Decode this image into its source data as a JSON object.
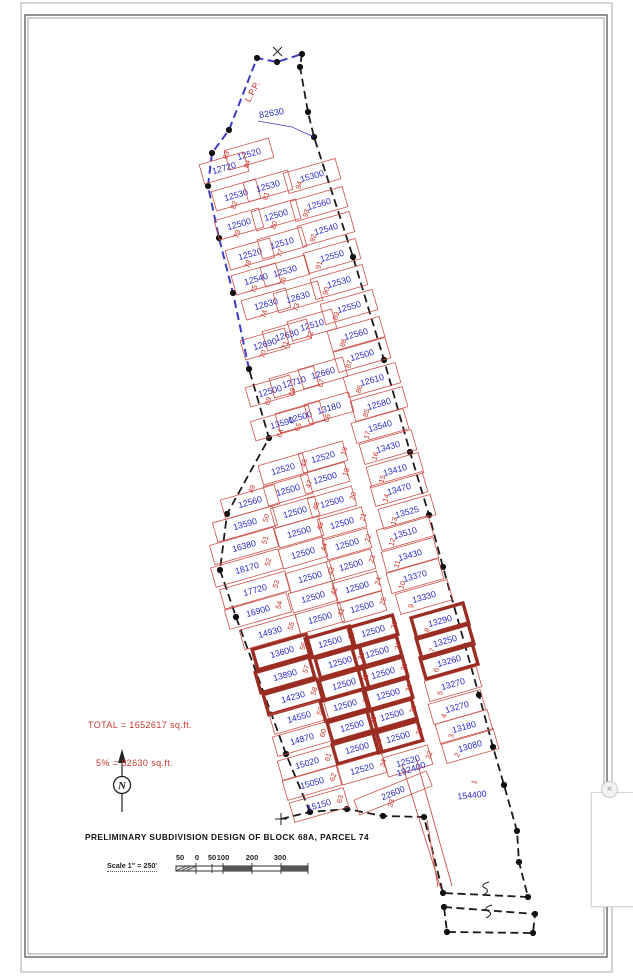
{
  "title_block": {
    "title": "PRELIMINARY SUBDIVISION DESIGN OF BLOCK 68A, PARCEL 74",
    "scale_label": "Scale 1\" = 250'",
    "scale_ticks": [
      "50",
      "0",
      "50",
      "100",
      "200",
      "300"
    ]
  },
  "summary": {
    "total_line": "TOTAL = 1652617 sq.ft.",
    "five_pct_line": "5% = 82630 sq.ft."
  },
  "north_arrow": {
    "letter": "N"
  },
  "overlay": {
    "close_glyph": "×"
  },
  "colors": {
    "lot_line_red": "#cd5149",
    "highlight_maroon": "#9c2d23",
    "area_label_blue": "#2a2ac8",
    "lot_number_red": "#c8372d",
    "boundary_black": "#1a1a1a",
    "boundary_blue": "#3c3cc4"
  },
  "map": {
    "free_labels": [
      {
        "text": "L.P.P.",
        "x": 255,
        "y": 93,
        "rot": -62,
        "color": "red"
      },
      {
        "text": "82630",
        "x": 272,
        "y": 116,
        "rot": -10,
        "color": "blue"
      },
      {
        "text": "192400",
        "x": 412,
        "y": 772,
        "rot": -18,
        "color": "blue"
      }
    ],
    "lots": {
      "columns": [
        "lot",
        "area_sqft",
        "x",
        "y",
        "number_side",
        "highlighted",
        "w",
        "h",
        "rot"
      ],
      "rows": [
        [
          "84",
          "12520",
          249,
          154,
          "b",
          false
        ],
        [
          "83",
          "12720",
          224,
          168,
          "t",
          false
        ],
        [
          "82",
          "12530",
          236,
          195,
          "b",
          false
        ],
        [
          "81",
          "12530",
          268,
          186,
          "b",
          false
        ],
        [
          "80",
          "12500",
          276,
          215,
          "b",
          false
        ],
        [
          "79",
          "12500",
          239,
          224,
          "b",
          false
        ],
        [
          "78",
          "12520",
          250,
          254,
          "b",
          false
        ],
        [
          "77",
          "12510",
          282,
          243,
          "b",
          false
        ],
        [
          "76",
          "12530",
          285,
          271,
          "b",
          false
        ],
        [
          "75",
          "12540",
          256,
          279,
          "b",
          false
        ],
        [
          "74",
          "12630",
          266,
          304,
          "b",
          false
        ],
        [
          "73",
          "12630",
          298,
          297,
          "b",
          false
        ],
        [
          "72",
          "12510",
          312,
          325,
          "b",
          false
        ],
        [
          "71",
          "12630",
          287,
          335,
          "b",
          false
        ],
        [
          "70",
          "12690",
          265,
          344,
          "b",
          false
        ],
        [
          "69",
          "12500",
          270,
          391,
          "b",
          false
        ],
        [
          "68",
          "12710",
          294,
          382,
          "b",
          false
        ],
        [
          "67",
          "12660",
          323,
          373,
          "b",
          false
        ],
        [
          "66",
          "13180",
          329,
          408,
          "b",
          false
        ],
        [
          "65",
          "12500",
          300,
          417,
          "b",
          false
        ],
        [
          "64",
          "13590",
          282,
          423,
          "b",
          false,
          60
        ],
        [
          "94",
          "15300",
          312,
          176,
          "bl",
          false,
          54,
          21
        ],
        [
          "93",
          "12560",
          319,
          204,
          "bl",
          false,
          54,
          21
        ],
        [
          "92",
          "12540",
          326,
          229,
          "bl",
          false,
          54,
          21
        ],
        [
          "91",
          "12550",
          332,
          256,
          "bl",
          false,
          54,
          21
        ],
        [
          "90",
          "12530",
          339,
          282,
          "bl",
          false,
          54,
          21
        ],
        [
          "89",
          "12550",
          349,
          307,
          "bl",
          false,
          54,
          21
        ],
        [
          "88",
          "12560",
          356,
          334,
          "bl",
          false,
          54,
          21
        ],
        [
          "87",
          "12500",
          362,
          355,
          "bl",
          false,
          54,
          21
        ],
        [
          "86",
          "12610",
          372,
          380,
          "bl",
          false,
          54,
          21
        ],
        [
          "85",
          "12580",
          379,
          404,
          "bl",
          false,
          54,
          21
        ],
        [
          "17",
          "13540",
          380,
          426,
          "bl",
          false,
          54,
          21
        ],
        [
          "16",
          "13430",
          388,
          447,
          "bl",
          false,
          54,
          21
        ],
        [
          "15",
          "13410",
          395,
          470,
          "bl",
          false,
          54,
          21
        ],
        [
          "14",
          "13470",
          399,
          489,
          "bl",
          false,
          54,
          21
        ],
        [
          "13",
          "13525",
          407,
          512,
          "bl",
          false,
          54,
          21
        ],
        [
          "12",
          "13510",
          405,
          533,
          "bl",
          false,
          54,
          21
        ],
        [
          "11",
          "13430",
          410,
          555,
          "bl",
          false,
          54,
          21
        ],
        [
          "10",
          "13370",
          415,
          576,
          "bl",
          false,
          54,
          21
        ],
        [
          "9",
          "13330",
          424,
          597,
          "bl",
          false,
          54,
          21
        ],
        [
          "8",
          "13290",
          440,
          621,
          "bl",
          true,
          54,
          22
        ],
        [
          "7",
          "13250",
          445,
          641,
          "bl",
          true,
          54,
          22
        ],
        [
          "6",
          "13260",
          449,
          661,
          "bl",
          true,
          54,
          22
        ],
        [
          "5",
          "13270",
          453,
          684,
          "bl",
          false,
          54,
          21
        ],
        [
          "4",
          "13270",
          457,
          707,
          "bl",
          false,
          54,
          21
        ],
        [
          "3",
          "13180",
          464,
          727,
          "bl",
          false,
          54,
          21
        ],
        [
          "2",
          "13080",
          470,
          746,
          "bl",
          false,
          54,
          21
        ],
        [
          "1",
          "154400",
          472,
          795,
          "t",
          false,
          0,
          0,
          -6
        ],
        [
          "49",
          "12560",
          250,
          502,
          "t",
          false,
          56
        ],
        [
          "50",
          "13590",
          245,
          524,
          "r",
          false,
          62
        ],
        [
          "51",
          "16380",
          244,
          546,
          "r",
          false,
          66
        ],
        [
          "52",
          "18170",
          247,
          568,
          "r",
          false,
          70
        ],
        [
          "53",
          "17720",
          255,
          590,
          "r",
          false,
          68
        ],
        [
          "54",
          "16900",
          258,
          611,
          "r",
          false,
          64
        ],
        [
          "55",
          "14930",
          270,
          632,
          "r",
          false,
          58
        ],
        [
          "56",
          "13600",
          282,
          652,
          "r",
          true,
          56,
          21
        ],
        [
          "57",
          "13890",
          285,
          675,
          "r",
          true,
          56,
          21
        ],
        [
          "58",
          "14230",
          293,
          697,
          "r",
          true,
          56,
          21
        ],
        [
          "59",
          "14550",
          299,
          717,
          "r",
          false,
          56
        ],
        [
          "60",
          "14870",
          302,
          739,
          "r",
          false,
          56
        ],
        [
          "61",
          "15020",
          307,
          763,
          "r",
          false,
          56
        ],
        [
          "62",
          "15050",
          312,
          783,
          "r",
          false,
          56
        ],
        [
          "63",
          "15150",
          319,
          805,
          "r",
          false,
          56
        ],
        [
          "48",
          "12520",
          283,
          469,
          "r",
          false
        ],
        [
          "47",
          "12500",
          288,
          490,
          "r",
          false
        ],
        [
          "46",
          "12500",
          295,
          512,
          "r",
          false
        ],
        [
          "45",
          "12500",
          299,
          532,
          "r",
          false
        ],
        [
          "44",
          "12500",
          303,
          553,
          "r",
          false
        ],
        [
          "43",
          "12500",
          310,
          577,
          "r",
          false
        ],
        [
          "42",
          "12500",
          313,
          597,
          "r",
          false
        ],
        [
          "41",
          "12500",
          320,
          618,
          "r",
          false
        ],
        [
          "40",
          "12500",
          330,
          642,
          "r",
          true
        ],
        [
          "39",
          "12500",
          340,
          662,
          "r",
          true
        ],
        [
          "38",
          "12500",
          344,
          684,
          "r",
          true
        ],
        [
          "37",
          "12500",
          345,
          705,
          "r",
          true
        ],
        [
          "36",
          "12500",
          352,
          726,
          "r",
          true
        ],
        [
          "35",
          "12500",
          357,
          748,
          "r",
          true
        ],
        [
          "34",
          "12520",
          362,
          769,
          "r",
          false
        ],
        [
          "18",
          "12520",
          323,
          457,
          "r",
          false
        ],
        [
          "19",
          "12500",
          325,
          478,
          "r",
          false
        ],
        [
          "20",
          "12500",
          332,
          502,
          "r",
          false
        ],
        [
          "21",
          "12500",
          342,
          523,
          "r",
          false
        ],
        [
          "22",
          "12500",
          347,
          544,
          "r",
          false
        ],
        [
          "23",
          "12500",
          351,
          565,
          "r",
          false
        ],
        [
          "24",
          "12500",
          357,
          587,
          "r",
          false
        ],
        [
          "25",
          "12500",
          362,
          607,
          "r",
          false
        ],
        [
          "26",
          "12500",
          373,
          631,
          "r",
          true
        ],
        [
          "27",
          "12500",
          377,
          652,
          "r",
          true
        ],
        [
          "28",
          "12500",
          383,
          673,
          "r",
          true
        ],
        [
          "29",
          "12500",
          388,
          694,
          "r",
          true
        ],
        [
          "30",
          "12500",
          392,
          715,
          "r",
          true
        ],
        [
          "31",
          "12500",
          398,
          737,
          "r",
          true
        ],
        [
          "32",
          "12520",
          408,
          761,
          "r",
          false
        ],
        [
          "33",
          "22600",
          393,
          793,
          "b",
          false,
          78,
          16,
          -22
        ]
      ]
    }
  }
}
